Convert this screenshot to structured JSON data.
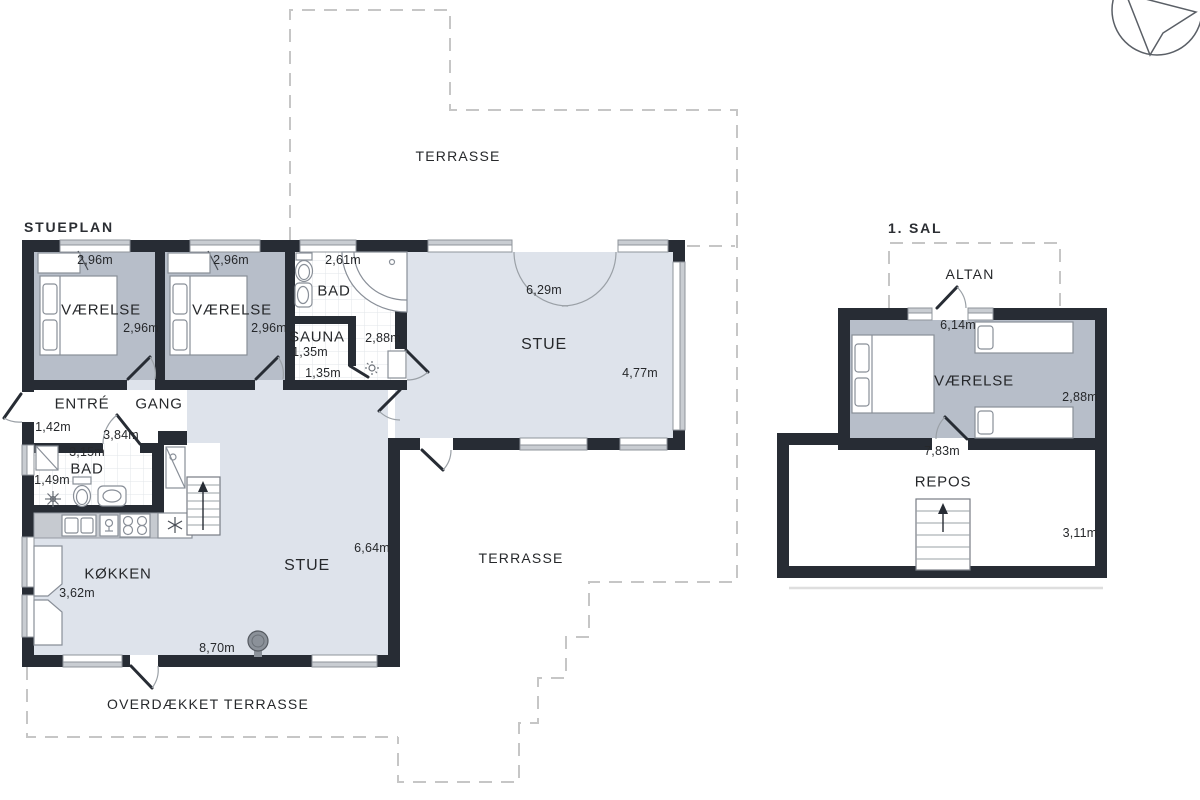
{
  "colors": {
    "wall": "#272c34",
    "bedroom_floor": "#b7bec9",
    "living_floor": "#dee3eb",
    "window_band": "#c9cdd2",
    "counter": "#c6cad0",
    "dash_line": "#c6c6c6",
    "text": "#26282b"
  },
  "icons": {
    "compass": "north-arrow",
    "stairs": "staircase-up",
    "stove": "wood-stove"
  },
  "ground": {
    "title": "STUEPLAN",
    "terrace_top": "TERRASSE",
    "terrace_mid": "TERRASSE",
    "covered_terrace": "OVERDÆKKET TERRASSE",
    "bedroom1": {
      "name": "VÆRELSE",
      "width": "2,96m",
      "depth": "2,96m"
    },
    "bedroom2": {
      "name": "VÆRELSE",
      "width": "2,96m",
      "depth": "2,96m"
    },
    "bath1": {
      "name": "BAD",
      "width": "2,61m"
    },
    "sauna": {
      "name": "SAUNA",
      "width": "1,35m",
      "depth": "1,35m"
    },
    "hall": {
      "width": "2,88m"
    },
    "living1": {
      "name": "STUE",
      "width": "6,29m",
      "depth": "4,77m"
    },
    "entry": {
      "name": "ENTRÉ",
      "width": "1,42m"
    },
    "hallway": {
      "name": "GANG",
      "width": "3,84m"
    },
    "bath2": {
      "name": "BAD",
      "width": "3,15m",
      "depth": "1,49m"
    },
    "kitchen": {
      "name": "KØKKEN",
      "depth": "3,62m"
    },
    "living2": {
      "name": "STUE",
      "depth": "6,64m",
      "width": "8,70m"
    }
  },
  "first": {
    "title": "1. SAL",
    "balcony": {
      "name": "ALTAN",
      "width": "6,14m"
    },
    "bedroom": {
      "name": "VÆRELSE",
      "depth": "2,88m",
      "width": "7,83m"
    },
    "landing": {
      "name": "REPOS",
      "depth": "3,11m"
    }
  }
}
